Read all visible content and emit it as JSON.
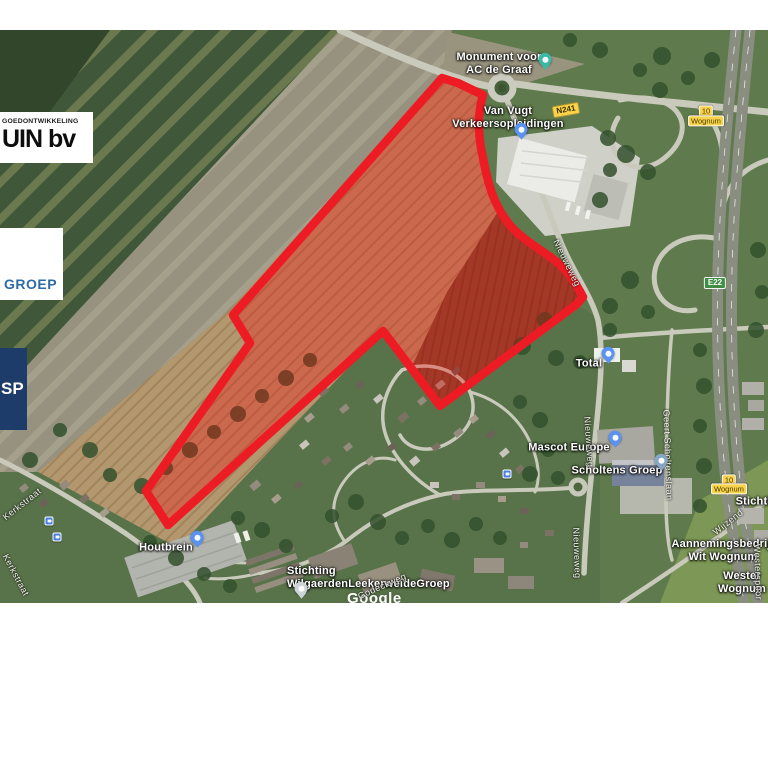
{
  "logos": [
    {
      "id": "vastgoed",
      "line1": "GOEDONTWIKKELING",
      "line2": "UIN bv"
    },
    {
      "id": "groep",
      "text": "GROEP",
      "color": "#2e6ba8"
    },
    {
      "id": "sp",
      "text": "SP",
      "bg": "#1e3c69"
    }
  ],
  "map": {
    "watermark": "Google",
    "overlay": {
      "stroke": "#ed1c24",
      "fill": "#ff0000",
      "fill_opacity": 0.3
    },
    "poi_labels": [
      {
        "id": "monument",
        "text": "Monument voor\nAC de Graaf",
        "x": 499,
        "y": 34
      },
      {
        "id": "van-vugt",
        "text": "Van Vugt\nVerkeersopleidingen",
        "x": 508,
        "y": 88
      },
      {
        "id": "total",
        "text": "Total",
        "x": 589,
        "y": 334
      },
      {
        "id": "mascot-europe",
        "text": "Mascot Europe",
        "x": 569,
        "y": 418
      },
      {
        "id": "scholtens-groep",
        "text": "Scholtens Groep",
        "x": 617,
        "y": 441
      },
      {
        "id": "houtbrein",
        "text": "Houtbrein",
        "x": 166,
        "y": 518
      },
      {
        "id": "wilgaerden",
        "text": "Stichting\nWilgaerdenLeekerweideGroep",
        "x": 287,
        "y": 548,
        "align": "left"
      },
      {
        "id": "stichting-right",
        "text": "Stichting",
        "x": 760,
        "y": 472
      },
      {
        "id": "aannemingsbedrijf",
        "text": "Aannemingsbedrijf\nWit Wognum",
        "x": 723,
        "y": 521
      },
      {
        "id": "wester-wognum",
        "text": "Wester Wognum",
        "x": 742,
        "y": 553
      }
    ],
    "street_labels": [
      {
        "id": "kerkstraat-upper",
        "text": "Kerkstraat",
        "x": 22,
        "y": 474,
        "rotate": -38
      },
      {
        "id": "kerkstraat-lower",
        "text": "Kerkstraat",
        "x": 16,
        "y": 545,
        "rotate": 62
      },
      {
        "id": "nieuweweg-north",
        "text": "Nieuweweg",
        "x": 567,
        "y": 233,
        "rotate": 64
      },
      {
        "id": "nieuweweg-mid",
        "text": "Nieuweweg",
        "x": 589,
        "y": 412,
        "rotate": 86
      },
      {
        "id": "nieuweweg-south",
        "text": "Nieuweweg",
        "x": 577,
        "y": 523,
        "rotate": 88
      },
      {
        "id": "geert-scholtenslaan",
        "text": "Geert Scholtenslaan",
        "x": 668,
        "y": 425,
        "rotate": 88
      },
      {
        "id": "wijzend",
        "text": "Wijzend",
        "x": 728,
        "y": 492,
        "rotate": -38
      },
      {
        "id": "westerspoor",
        "text": "Westerspoor",
        "x": 758,
        "y": 542,
        "rotate": 88
      },
      {
        "id": "godeckweg",
        "text": "Godeckweg",
        "x": 382,
        "y": 556,
        "rotate": -24
      }
    ],
    "badges": [
      {
        "id": "n241",
        "type": "road",
        "text": "N241",
        "x": 566,
        "y": 80,
        "rotate": -10
      },
      {
        "id": "exit-10-north",
        "type": "exit",
        "text": "10",
        "x": 706,
        "y": 81,
        "rotate": 0
      },
      {
        "id": "exit-wognum-north",
        "type": "exit",
        "text": "Wognum",
        "x": 706,
        "y": 91,
        "rotate": 0
      },
      {
        "id": "e22",
        "type": "euro",
        "text": "E22",
        "x": 715,
        "y": 253,
        "rotate": 0
      },
      {
        "id": "exit-10-south",
        "type": "exit",
        "text": "10",
        "x": 729,
        "y": 450,
        "rotate": 0
      },
      {
        "id": "exit-wognum-south",
        "type": "exit",
        "text": "Wognum",
        "x": 729,
        "y": 459,
        "rotate": 0
      }
    ],
    "pins": [
      {
        "id": "monument",
        "x": 545,
        "y": 37,
        "color": "#3cb8a6"
      },
      {
        "id": "van-vugt",
        "x": 521,
        "y": 107,
        "color": "#5a91f2"
      },
      {
        "id": "total",
        "x": 608,
        "y": 331,
        "color": "#5a91f2"
      },
      {
        "id": "mascot-europe",
        "x": 615,
        "y": 415,
        "color": "#5a91f2"
      },
      {
        "id": "scholtens-groep",
        "x": 661,
        "y": 438,
        "color": "#86a7c4"
      },
      {
        "id": "houtbrein",
        "x": 197,
        "y": 515,
        "color": "#5a91f2"
      },
      {
        "id": "wilgaerden",
        "x": 301,
        "y": 566,
        "color": "#ccd4d8"
      }
    ],
    "bus_stops": [
      {
        "x": 49,
        "y": 491
      },
      {
        "x": 57,
        "y": 507
      },
      {
        "x": 507,
        "y": 444
      }
    ]
  }
}
